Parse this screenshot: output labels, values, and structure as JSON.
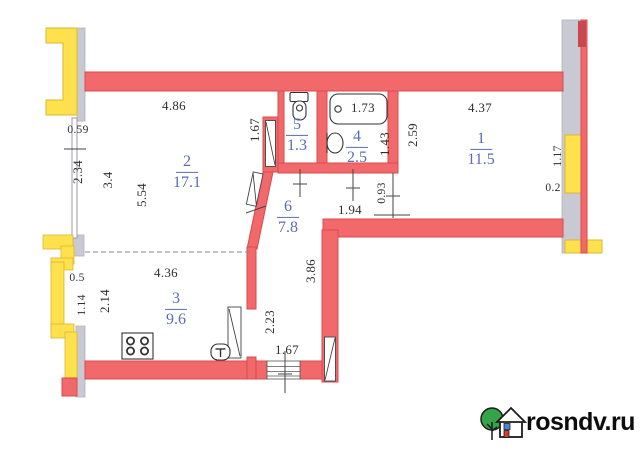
{
  "colors": {
    "wall": "#f2696b",
    "wall_outline": "#d84a4c",
    "window": "#ffe14e",
    "window_outline": "#d9b832",
    "partition": "#c9c9d3",
    "room_label": "#5c6cb4",
    "dimension_text": "#2e2e2e",
    "logo_tree": "#36a24a",
    "logo_door": "#d5382e",
    "logo_window": "#4a84d6"
  },
  "rooms": [
    {
      "number": "1",
      "area": "11.5"
    },
    {
      "number": "2",
      "area": "17.1"
    },
    {
      "number": "3",
      "area": "9.6"
    },
    {
      "number": "4",
      "area": "2.5"
    },
    {
      "number": "5",
      "area": "1.3"
    },
    {
      "number": "6",
      "area": "7.8"
    }
  ],
  "dimensions": {
    "top_left_width": "4.86",
    "top_right_width": "4.37",
    "left_upper_offset": "0.59",
    "left_upper_height": "2.34",
    "room2_height_a": "3.4",
    "room2_height_b": "5.54",
    "hall_passage_height": "1.67",
    "bath_height": "1.43",
    "room1_left_height": "2.59",
    "right_window_height": "1.17",
    "right_wall_thickness": "0.2",
    "hall_opening": "0.93",
    "hall_width": "1.94",
    "hall_height": "3.86",
    "kitchen_door_height": "2.23",
    "kitchen_width": "4.36",
    "kitchen_left_offset": "0.5",
    "kitchen_window_a": "1.14",
    "kitchen_left_height": "2.14",
    "entry_width": "1.67",
    "bathtub_length": "1.73"
  },
  "watermark": {
    "site": "rosndv.ru"
  }
}
